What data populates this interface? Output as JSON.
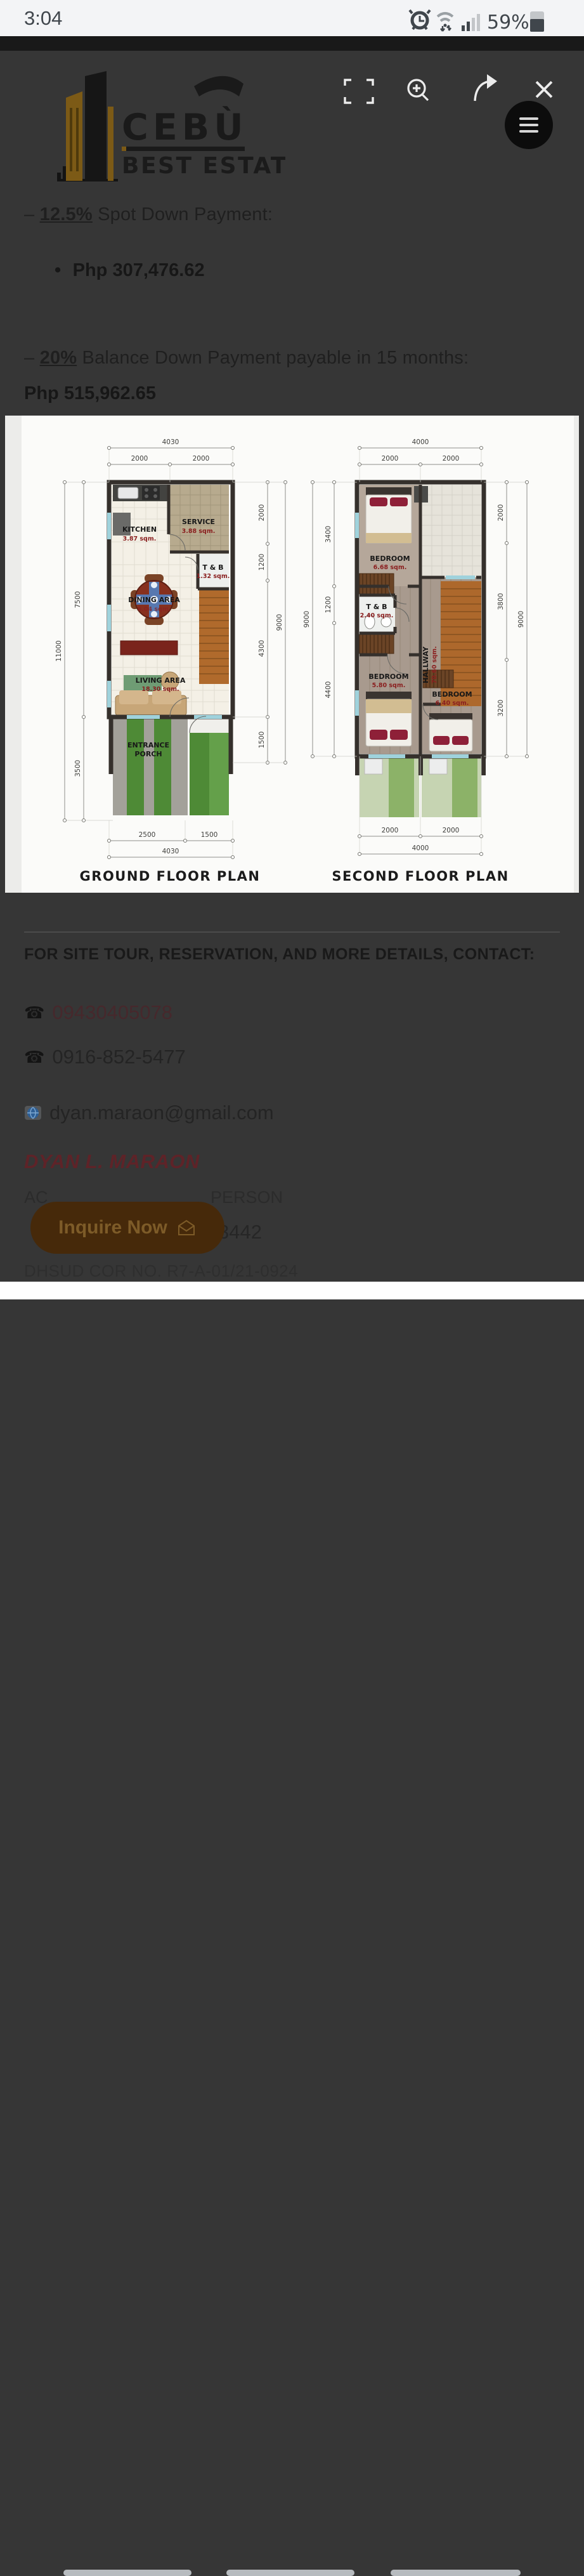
{
  "status_bar": {
    "time": "3:04",
    "battery_pct": "59%"
  },
  "logo": {
    "line1": "CEBÙ",
    "line2": "BEST ESTATE"
  },
  "payment": {
    "dash": "–",
    "bullet": "•",
    "spot_pct": "12.5%",
    "spot_text": "Spot Down Payment:",
    "spot_amount": "Php 307,476.62",
    "balance_pct": "20%",
    "balance_text": "Balance Down Payment payable in 15 months:",
    "balance_amount": "Php 515,962.65"
  },
  "plans": {
    "ground": {
      "title": "GROUND FLOOR PLAN",
      "dims": {
        "top_overall": "4030",
        "top_left": "2000",
        "top_right": "2000",
        "left_outer": "11000",
        "left_upper": "7500",
        "left_lower": "3500",
        "right_1": "2000",
        "right_2": "1200",
        "right_3": "4300",
        "right_4": "1500",
        "right_outer": "9000",
        "bottom_left": "2500",
        "bottom_right": "1500",
        "bottom_overall": "4030"
      },
      "rooms": {
        "kitchen": {
          "name": "KITCHEN",
          "area": "3.87 sqm."
        },
        "service": {
          "name": "SERVICE",
          "area": "3.88 sqm."
        },
        "tb": {
          "name": "T & B",
          "area": "1.32 sqm."
        },
        "dining": {
          "name": "DINING AREA",
          "area": "6.04 sqm."
        },
        "living": {
          "name": "LIVING AREA",
          "area": "18.30 sqm."
        },
        "porch_l1": "ENTRANCE",
        "porch_l2": "PORCH"
      }
    },
    "second": {
      "title": "SECOND FLOOR PLAN",
      "dims": {
        "top_overall": "4000",
        "top_left": "2000",
        "top_right": "2000",
        "left_outer": "9000",
        "left_1": "3400",
        "left_2": "1200",
        "left_3": "4400",
        "right_1": "2000",
        "right_2": "3800",
        "right_3": "3200",
        "right_outer": "9000",
        "bottom_left": "2000",
        "bottom_right": "2000",
        "bottom_overall": "4000"
      },
      "rooms": {
        "bedroom1": {
          "name": "BEDROOM",
          "area": "6.68 sqm."
        },
        "tb": {
          "name": "T & B",
          "area": "2.40 sqm."
        },
        "hallway": {
          "name": "HALLWAY",
          "area": "70.60 sqm."
        },
        "bedroom2": {
          "name": "BEDROOM",
          "area": "5.80 sqm."
        },
        "bedroom3": {
          "name": "BEDROOM",
          "area": "6.40 sqm."
        }
      }
    }
  },
  "contact": {
    "heading": "FOR SITE TOUR, RESERVATION, AND MORE DETAILS, CONTACT:",
    "phone_icon": "☎",
    "phone1": "09430405078",
    "phone2": "0916-852-5477",
    "email": "dyan.maraon@gmail.com",
    "agent_name": "DYAN L. MARAON",
    "accreditation_left": "AC",
    "accreditation_right": "PERSON",
    "license_fragment": "3442",
    "dhsud": "DHSUD COR NO. R7-A-01/21-0924"
  },
  "cta": {
    "label": "Inquire Now"
  },
  "colors": {
    "accent_orange": "#f0a500",
    "link_maroon": "#8a2a33",
    "page_dim": "#363636"
  }
}
